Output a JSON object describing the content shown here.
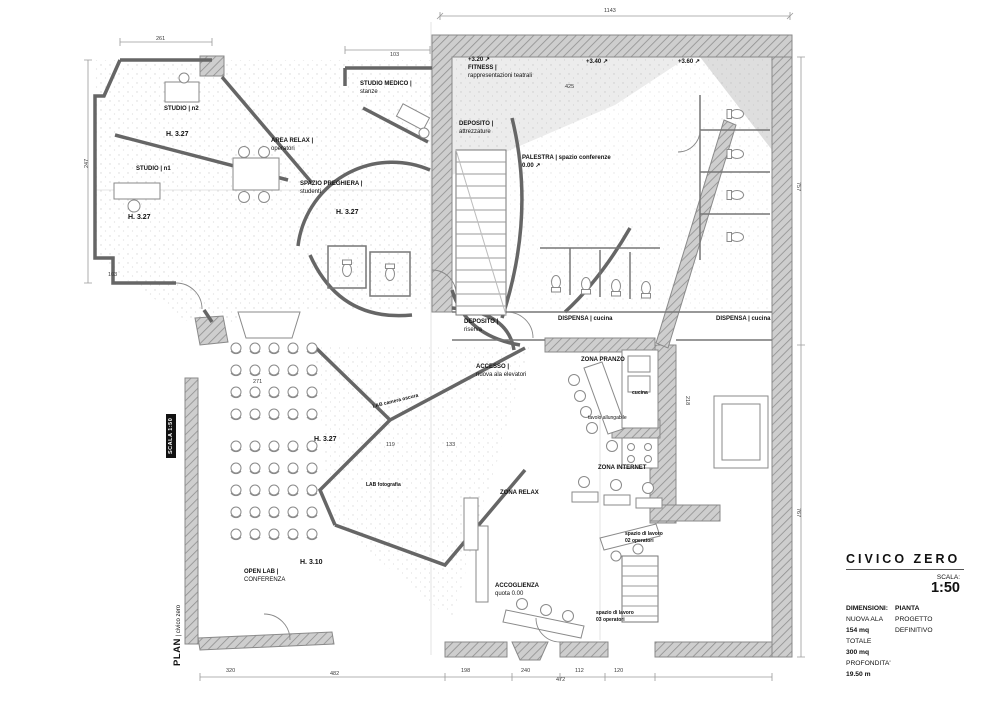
{
  "colors": {
    "wall_fill": "#cecece",
    "wall_line": "#8f8f8f",
    "thin_wall": "#666666",
    "dots": "#b5b5b5",
    "accent": "#111111"
  },
  "side": {
    "scale_badge": "SCALA 1:50",
    "plan_label": "PLAN",
    "plan_sub": "| civico zero"
  },
  "title_block": {
    "project": "CIVICO ZERO",
    "scale_label": "SCALA:",
    "scale_value": "1:50",
    "info_col1": [
      {
        "t": "DIMENSIONI:",
        "b": true
      },
      {
        "t": "NUOVA ALA",
        "b": false
      },
      {
        "t": "154 mq",
        "b": true
      },
      {
        "t": "TOTALE",
        "b": false
      },
      {
        "t": "300 mq",
        "b": true
      },
      {
        "t": "PROFONDITA'",
        "b": false
      },
      {
        "t": "19.50 m",
        "b": true
      }
    ],
    "info_col2": [
      {
        "t": "PIANTA",
        "b": true
      },
      {
        "t": "PROGETTO",
        "b": false
      },
      {
        "t": "DEFINITIVO",
        "b": false
      }
    ]
  },
  "plan": {
    "room_labels": [
      {
        "x": 164,
        "y": 106,
        "lines": [
          {
            "t": "STUDIO | n2",
            "b": 1
          }
        ]
      },
      {
        "x": 166,
        "y": 130,
        "fs": 7,
        "lines": [
          {
            "t": "H. 3.27",
            "b": 1
          }
        ]
      },
      {
        "x": 136,
        "y": 166,
        "lines": [
          {
            "t": "STUDIO | n1",
            "b": 1
          }
        ]
      },
      {
        "x": 128,
        "y": 213,
        "fs": 7,
        "lines": [
          {
            "t": "H. 3.27",
            "b": 1
          }
        ]
      },
      {
        "x": 271,
        "y": 138,
        "lines": [
          {
            "t": "AREA RELAX |",
            "b": 1
          },
          {
            "t": "operatori",
            "b": 0
          }
        ]
      },
      {
        "x": 300,
        "y": 181,
        "lines": [
          {
            "t": "SPAZIO PREGHIERA |",
            "b": 1
          },
          {
            "t": "studenti",
            "b": 0
          }
        ]
      },
      {
        "x": 336,
        "y": 208,
        "fs": 7,
        "lines": [
          {
            "t": "H. 3.27",
            "b": 1
          }
        ]
      },
      {
        "x": 360,
        "y": 81,
        "lines": [
          {
            "t": "STUDIO MEDICO |",
            "b": 1
          },
          {
            "t": "stanze",
            "b": 0
          }
        ]
      },
      {
        "x": 468,
        "y": 57,
        "lines": [
          {
            "t": "+3.20 ↗",
            "b": 1
          },
          {
            "t": "FITNESS |",
            "b": 1
          },
          {
            "t": "rappresentazioni teatrali",
            "b": 0
          }
        ]
      },
      {
        "x": 586,
        "y": 59,
        "lines": [
          {
            "t": "+3.40 ↗",
            "b": 1
          }
        ]
      },
      {
        "x": 678,
        "y": 59,
        "lines": [
          {
            "t": "+3.60 ↗",
            "b": 1
          }
        ]
      },
      {
        "x": 459,
        "y": 121,
        "lines": [
          {
            "t": "DEPOSITO |",
            "b": 1
          },
          {
            "t": "attrezzature",
            "b": 0
          }
        ]
      },
      {
        "x": 522,
        "y": 155,
        "lines": [
          {
            "t": "PALESTRA | spazio conferenze",
            "b": 1
          },
          {
            "t": "0.00 ↗",
            "b": 1
          }
        ]
      },
      {
        "x": 464,
        "y": 319,
        "lines": [
          {
            "t": "DEPOSITO |",
            "b": 1
          },
          {
            "t": "riserva",
            "b": 0
          }
        ]
      },
      {
        "x": 558,
        "y": 316,
        "lines": [
          {
            "t": "DISPENSA | cucina",
            "b": 1
          }
        ]
      },
      {
        "x": 716,
        "y": 316,
        "lines": [
          {
            "t": "DISPENSA | cucina",
            "b": 1
          }
        ]
      },
      {
        "x": 476,
        "y": 364,
        "lines": [
          {
            "t": "ACCESSO |",
            "b": 1
          },
          {
            "t": "nuova ala elevatori",
            "b": 0
          }
        ]
      },
      {
        "x": 581,
        "y": 357,
        "lines": [
          {
            "t": "ZONA PRANZO",
            "b": 1
          }
        ]
      },
      {
        "x": 632,
        "y": 390,
        "fs": 5,
        "lines": [
          {
            "t": "cucina",
            "b": 1
          }
        ]
      },
      {
        "x": 588,
        "y": 415,
        "fs": 5,
        "lines": [
          {
            "t": "tavolo allungabile",
            "b": 0
          }
        ]
      },
      {
        "x": 598,
        "y": 465,
        "lines": [
          {
            "t": "ZONA INTERNET",
            "b": 1
          }
        ]
      },
      {
        "x": 500,
        "y": 490,
        "lines": [
          {
            "t": "ZONA RELAX",
            "b": 1
          }
        ]
      },
      {
        "x": 625,
        "y": 531,
        "fs": 5,
        "lines": [
          {
            "t": "spazio di lavoro",
            "b": 1
          },
          {
            "t": "02 operatori",
            "b": 1
          }
        ]
      },
      {
        "x": 596,
        "y": 610,
        "fs": 5,
        "lines": [
          {
            "t": "spazio di lavoro",
            "b": 1
          },
          {
            "t": "03 operatori",
            "b": 1
          }
        ]
      },
      {
        "x": 495,
        "y": 583,
        "lines": [
          {
            "t": "ACCOGLIENZA",
            "b": 1
          },
          {
            "t": "quota 0.00",
            "b": 0
          }
        ]
      },
      {
        "x": 244,
        "y": 569,
        "lines": [
          {
            "t": "OPEN LAB |",
            "b": 1
          },
          {
            "t": "CONFERENZA",
            "b": 0
          }
        ]
      },
      {
        "x": 300,
        "y": 558,
        "fs": 7,
        "lines": [
          {
            "t": "H. 3.10",
            "b": 1
          }
        ]
      },
      {
        "x": 372,
        "y": 404,
        "fs": 5,
        "r": -14,
        "lines": [
          {
            "t": "LAB camera oscura",
            "b": 1
          }
        ]
      },
      {
        "x": 314,
        "y": 435,
        "fs": 7,
        "lines": [
          {
            "t": "H. 3.27",
            "b": 1
          }
        ]
      },
      {
        "x": 366,
        "y": 482,
        "fs": 5,
        "lines": [
          {
            "t": "LAB fotografia",
            "b": 1
          }
        ]
      }
    ],
    "dim_labels": [
      {
        "x": 604,
        "y": 8,
        "t": "1143"
      },
      {
        "x": 156,
        "y": 36,
        "t": "261"
      },
      {
        "x": 390,
        "y": 52,
        "t": "103"
      },
      {
        "x": 565,
        "y": 84,
        "t": "425"
      },
      {
        "x": 84,
        "y": 168,
        "t": "247",
        "r": -90
      },
      {
        "x": 108,
        "y": 272,
        "t": "103"
      },
      {
        "x": 801,
        "y": 182,
        "t": "757",
        "r": 90
      },
      {
        "x": 690,
        "y": 396,
        "t": "218",
        "r": 90
      },
      {
        "x": 801,
        "y": 508,
        "t": "767",
        "r": 90
      },
      {
        "x": 253,
        "y": 379,
        "t": "271"
      },
      {
        "x": 386,
        "y": 442,
        "t": "119"
      },
      {
        "x": 446,
        "y": 442,
        "t": "133"
      },
      {
        "x": 226,
        "y": 668,
        "t": "320"
      },
      {
        "x": 330,
        "y": 671,
        "t": "482"
      },
      {
        "x": 461,
        "y": 668,
        "t": "198"
      },
      {
        "x": 521,
        "y": 668,
        "t": "240"
      },
      {
        "x": 575,
        "y": 668,
        "t": "112"
      },
      {
        "x": 614,
        "y": 668,
        "t": "120"
      },
      {
        "x": 556,
        "y": 677,
        "t": "472"
      }
    ]
  }
}
